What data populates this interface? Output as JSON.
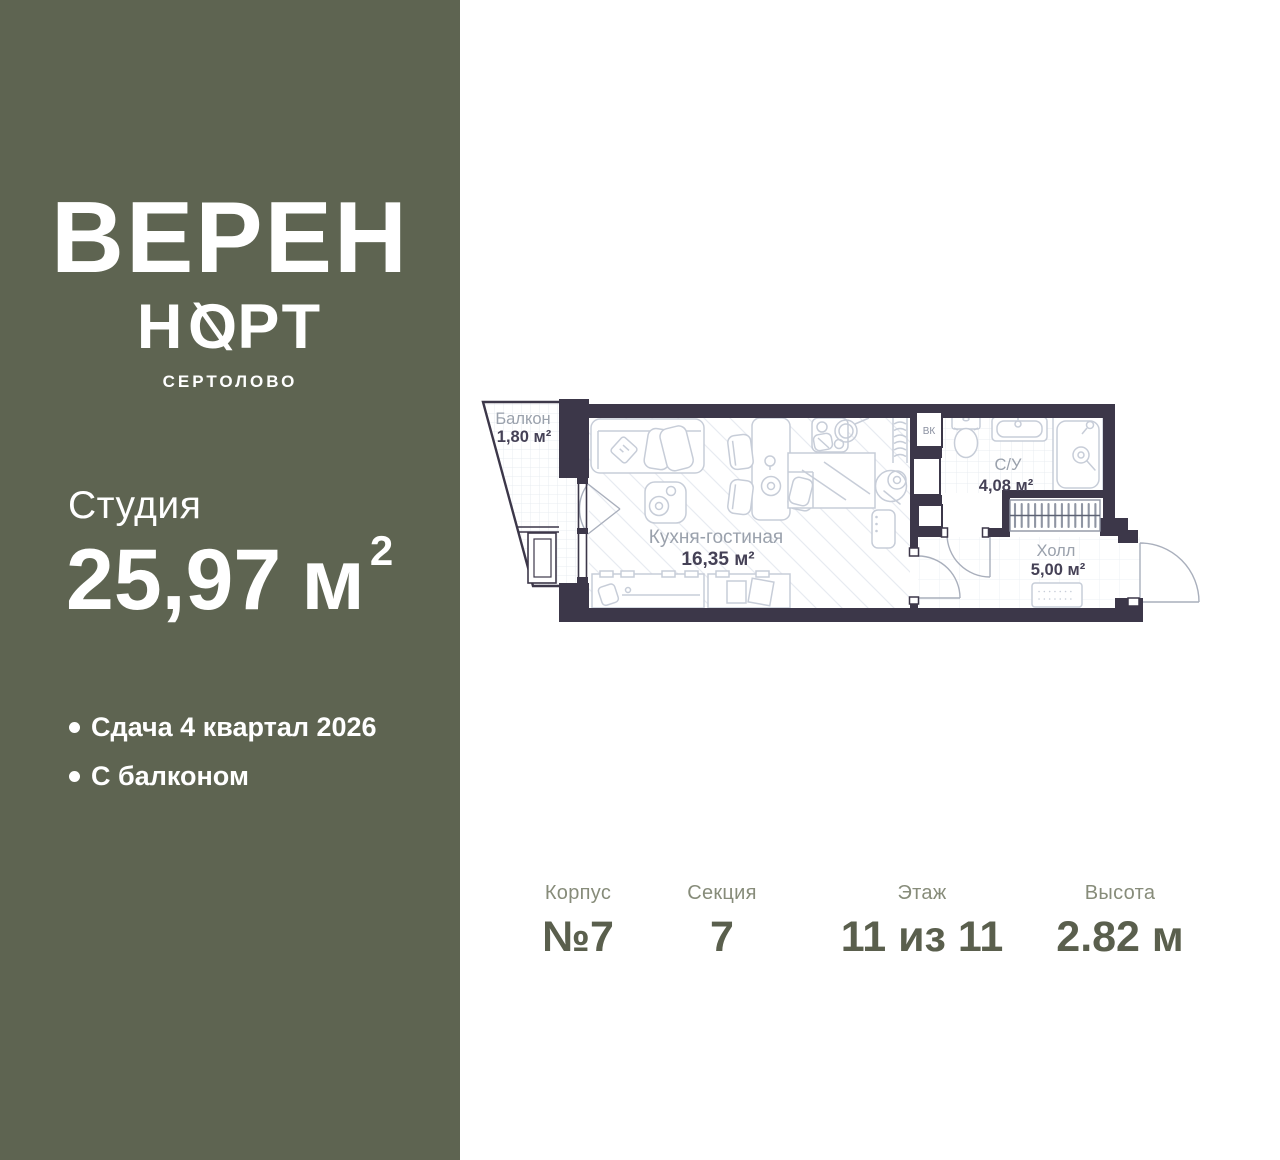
{
  "sidebar": {
    "logo_line1": "ВЕРЕН",
    "logo_line2_left": "Н",
    "logo_line2_o": "Ø",
    "logo_line2_right": "РТ",
    "logo_city": "СЕРТОЛОВО",
    "unit_type": "Студия",
    "area_value": "25,97",
    "area_unit": "м",
    "area_sup": "2",
    "features": [
      {
        "text": "Сдача 4 квартал 2026"
      },
      {
        "text": "С балконом"
      }
    ]
  },
  "floorplan": {
    "rooms": [
      {
        "name": "Балкон",
        "area": "1,80 м²"
      },
      {
        "name": "Кухня-гостиная",
        "area": "16,35 м²"
      },
      {
        "name": "С/У",
        "area": "4,08 м²"
      },
      {
        "name": "Холл",
        "area": "5,00 м²"
      }
    ],
    "shaft_label": "ВК"
  },
  "details": {
    "columns": [
      {
        "label": "Корпус",
        "value": "№7"
      },
      {
        "label": "Секция",
        "value": "7"
      },
      {
        "label": "Этаж",
        "value": "11 из 11"
      },
      {
        "label": "Высота",
        "value": "2.82 м"
      }
    ]
  },
  "colors": {
    "sidebar_background": "#5e6451",
    "wall": "#3c3749",
    "details_label": "#878c7a",
    "details_value": "#5a5f4d",
    "room_label_gray": "#9aa1ac",
    "room_area_dark": "#454156"
  }
}
